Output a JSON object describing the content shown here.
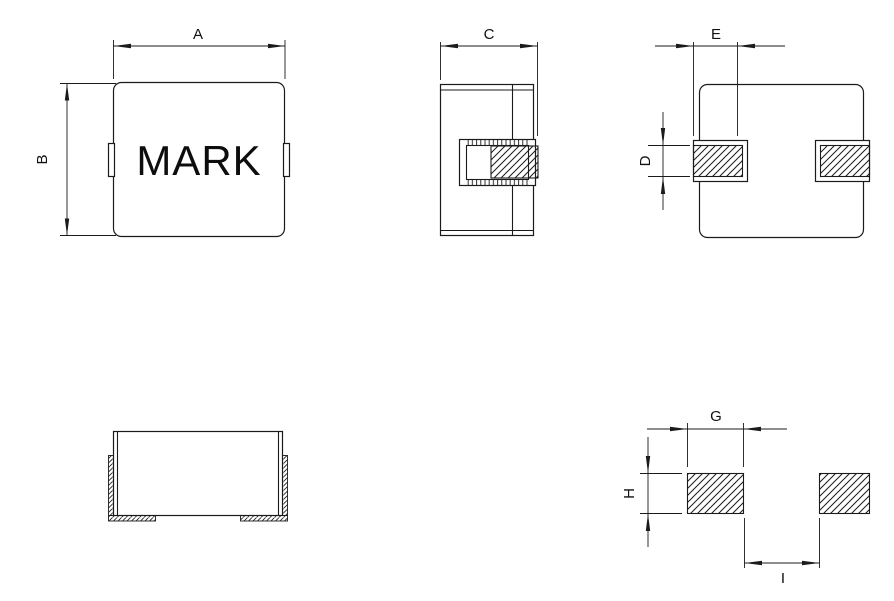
{
  "colors": {
    "line": "#1b1b1b",
    "background": "#ffffff"
  },
  "drawing": {
    "mark": "MARK",
    "dimensions": {
      "a": "A",
      "b": "B",
      "c": "C",
      "d": "D",
      "e": "E",
      "g": "G",
      "h": "H",
      "i": "I"
    }
  }
}
